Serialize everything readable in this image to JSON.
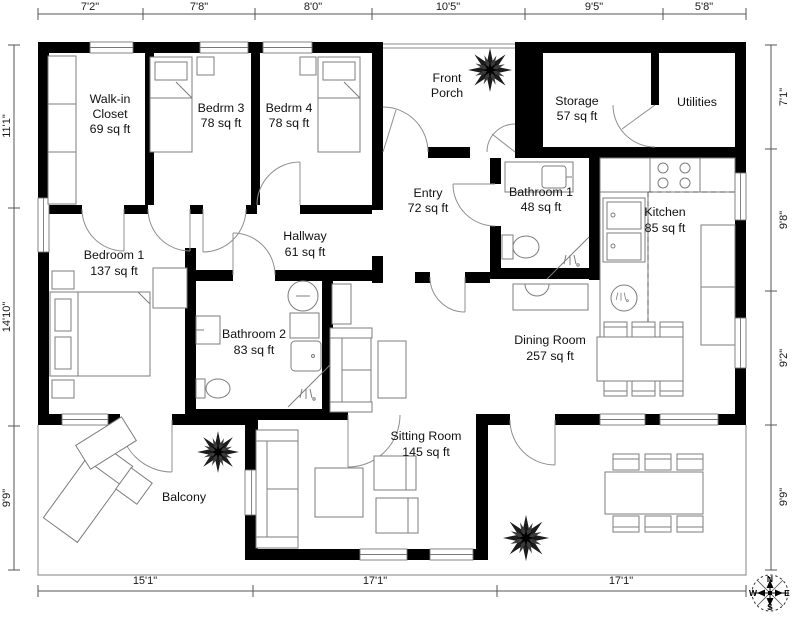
{
  "plan": {
    "rooms": [
      {
        "id": "walk-in-closet",
        "lines": [
          "Walk-in",
          "Closet",
          "69 sq ft"
        ]
      },
      {
        "id": "bedrm-3",
        "lines": [
          "Bedrm 3",
          "78 sq ft"
        ]
      },
      {
        "id": "bedrm-4",
        "lines": [
          "Bedrm 4",
          "78 sq ft"
        ]
      },
      {
        "id": "front-porch",
        "lines": [
          "Front",
          "Porch"
        ]
      },
      {
        "id": "storage",
        "lines": [
          "Storage",
          "57 sq ft"
        ]
      },
      {
        "id": "utilities",
        "lines": [
          "Utilities"
        ]
      },
      {
        "id": "entry",
        "lines": [
          "Entry",
          "72 sq ft"
        ]
      },
      {
        "id": "bathroom-1",
        "lines": [
          "Bathroom 1",
          "48 sq ft"
        ]
      },
      {
        "id": "kitchen",
        "lines": [
          "Kitchen",
          "85 sq ft"
        ]
      },
      {
        "id": "bedroom-1",
        "lines": [
          "Bedroom 1",
          "137 sq ft"
        ]
      },
      {
        "id": "hallway",
        "lines": [
          "Hallway",
          "61 sq ft"
        ]
      },
      {
        "id": "bathroom-2",
        "lines": [
          "Bathroom 2",
          "83 sq ft"
        ]
      },
      {
        "id": "dining-room",
        "lines": [
          "Dining Room",
          "257 sq ft"
        ]
      },
      {
        "id": "sitting-room",
        "lines": [
          "Sitting Room",
          "145 sq ft"
        ]
      },
      {
        "id": "balcony",
        "lines": [
          "Balcony"
        ]
      }
    ],
    "dimensions": {
      "top": [
        "7'2\"",
        "7'8\"",
        "8'0\"",
        "10'5\"",
        "9'5\"",
        "5'8\""
      ],
      "bottom": [
        "15'1\"",
        "17'1\"",
        "17'1\""
      ],
      "left": [
        "11'1\"",
        "14'10\"",
        "9'9\""
      ],
      "right": [
        "7'1\"",
        "9'8\"",
        "9'2\"",
        "9'9\""
      ]
    },
    "compass": {
      "north": "N",
      "east": "E",
      "south": "S",
      "west": "W"
    },
    "colors": {
      "wall": "#000000",
      "furniture_outline": "#7d7d7d",
      "background": "#ffffff"
    }
  }
}
